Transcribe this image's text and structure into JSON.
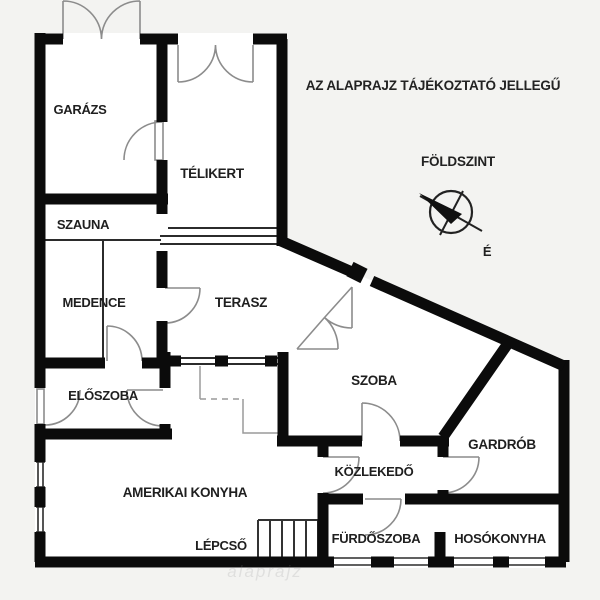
{
  "disclaimer": "AZ ALAPRAJZ TÁJÉKOZTATÓ JELLEGŰ",
  "floor_label": "FÖLDSZINT",
  "compass": {
    "north_label": "É"
  },
  "watermark": "alaprajz",
  "rooms": {
    "garazs": "GARÁZS",
    "telikert": "TÉLIKERT",
    "szauna": "SZAUNA",
    "medence": "MEDENCE",
    "terasz": "TERASZ",
    "eloszoba": "ELŐSZOBA",
    "szoba": "SZOBA",
    "gardrob": "GARDRÓB",
    "amerikai_konyha": "AMERIKAI KONYHA",
    "kozlekedo": "KÖZLEKEDŐ",
    "lepcso": "LÉPCSŐ",
    "furdoszoba": "FÜRDŐSZOBA",
    "hosokonyha": "HOSÓKONYHA"
  },
  "colors": {
    "background": "#f3f3f1",
    "room_fill": "#ffffff",
    "wall": "#0b0b0b",
    "thin_line": "#2b2b2b",
    "door_arc": "#8c8c8c",
    "label": "#1f1f1f"
  }
}
